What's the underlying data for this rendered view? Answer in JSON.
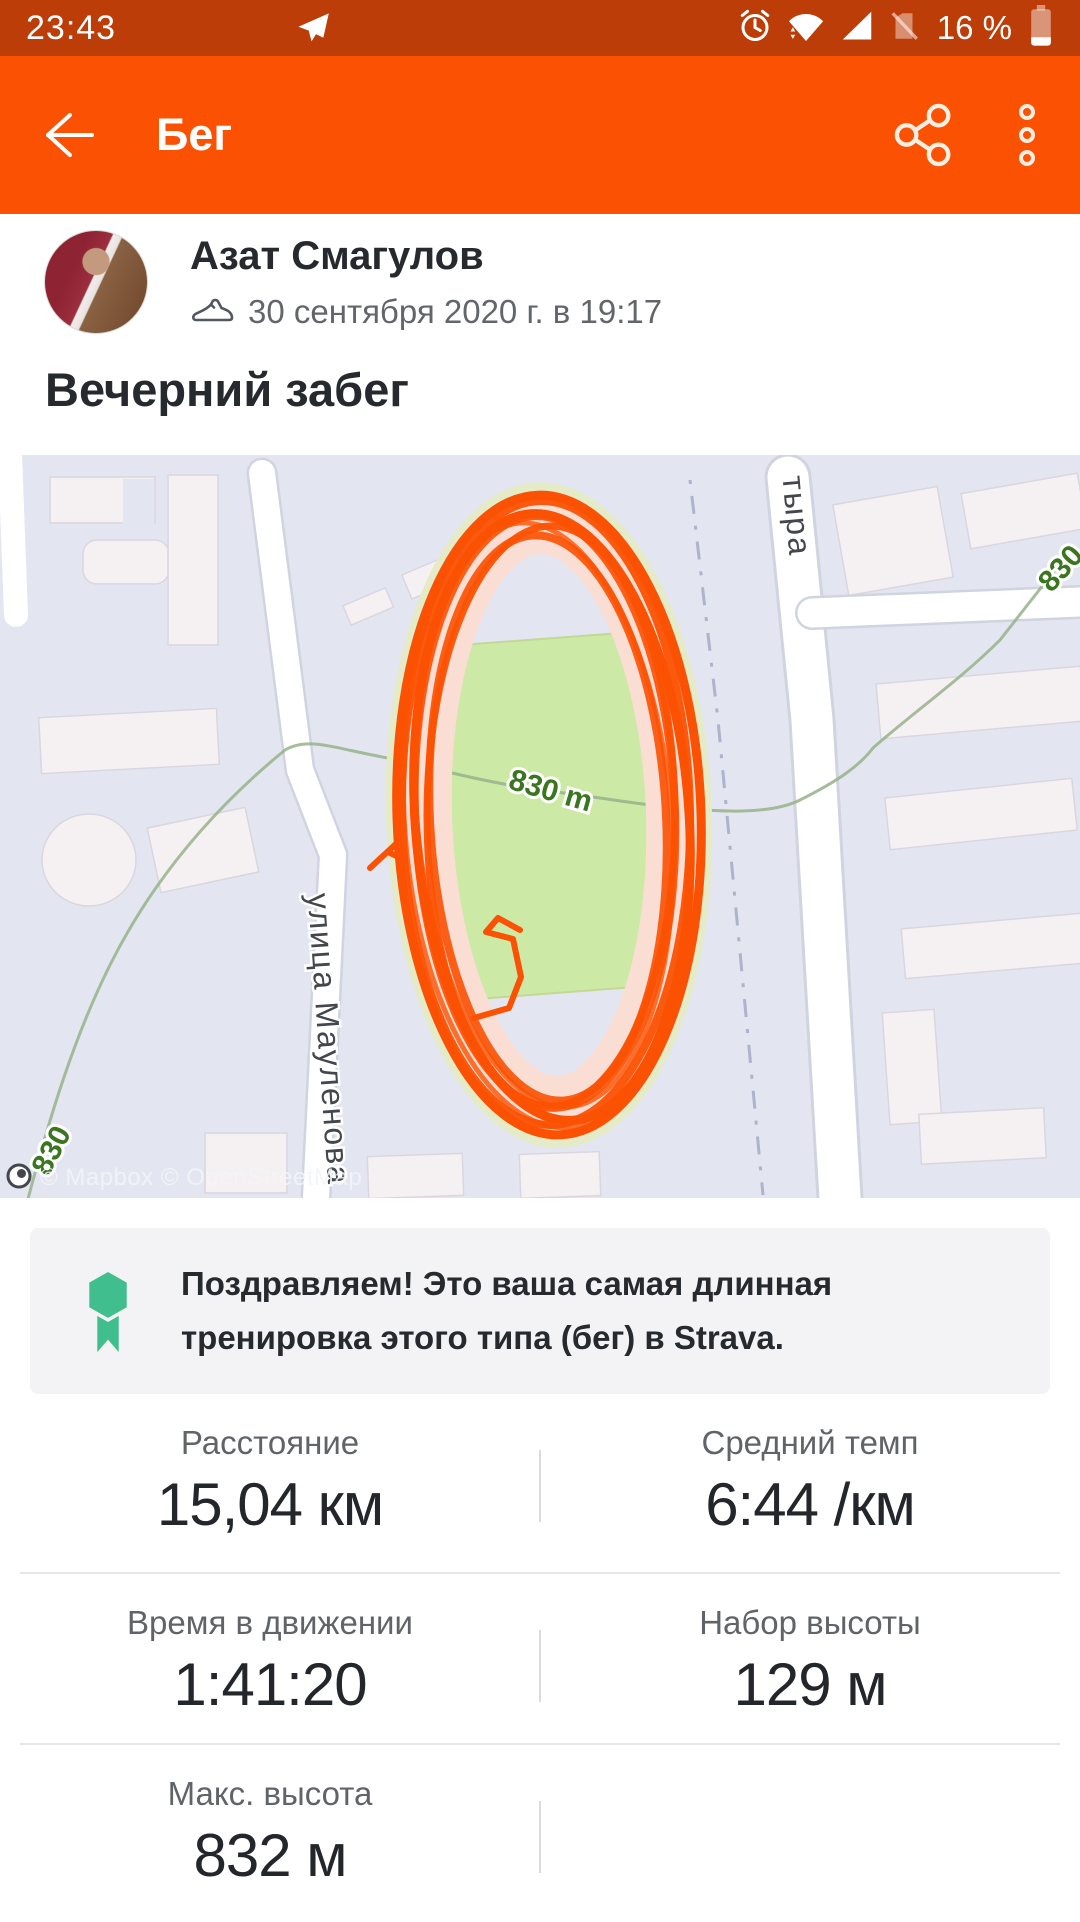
{
  "status_bar": {
    "time": "23:43",
    "battery_pct": "16 %",
    "icons": {
      "notification": "telegram-plane-icon",
      "alarm": "alarm-clock-icon",
      "wifi": "wifi-icon",
      "signal": "cell-signal-icon",
      "sim": "no-sim-icon",
      "battery": "battery-low-icon"
    }
  },
  "app_bar": {
    "title": "Бег"
  },
  "activity_header": {
    "athlete": "Азат Смагулов",
    "datetime": "30 сентября 2020 г. в 19:17",
    "title": "Вечерний забег"
  },
  "map": {
    "streets": {
      "left": "улица Мауленова",
      "top": "тыра"
    },
    "contours": {
      "left_label": "830",
      "field_label": "830 m",
      "right_label": "830"
    },
    "attribution": "© Mapbox © OpenStreetMap",
    "track_color": "#FB5102",
    "field_color": "#CDE9A6"
  },
  "achievement": {
    "message": "Поздравляем! Это ваша самая длинная тренировка этого типа (бег) в Strava.",
    "medal_color": "#41BE8E"
  },
  "stats": {
    "rows": [
      {
        "left": {
          "label": "Расстояние",
          "value": "15,04 км"
        },
        "right": {
          "label": "Средний темп",
          "value": "6:44 /км"
        }
      },
      {
        "left": {
          "label": "Время в движении",
          "value": "1:41:20"
        },
        "right": {
          "label": "Набор высоты",
          "value": "129 м"
        }
      },
      {
        "left": {
          "label": "Макс. высота",
          "value": "832 м"
        }
      }
    ]
  }
}
